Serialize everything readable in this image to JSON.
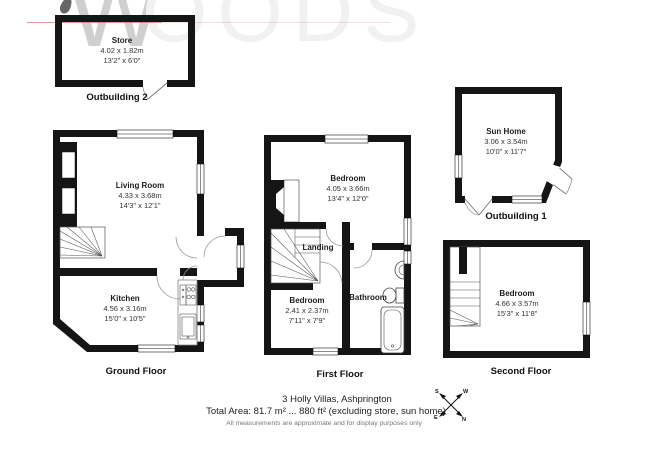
{
  "watermark": {
    "initial": "W",
    "rest": "OODS"
  },
  "outbuilding2": {
    "caption": "Outbuilding 2",
    "room": {
      "name": "Store",
      "metric": "4.02 x 1.82m",
      "imperial": "13'2\" x 6'0\""
    }
  },
  "ground_floor": {
    "caption": "Ground Floor",
    "living_room": {
      "name": "Living Room",
      "metric": "4.33 x 3.68m",
      "imperial": "14'3\" x 12'1\""
    },
    "kitchen": {
      "name": "Kitchen",
      "metric": "4.56 x 3.16m",
      "imperial": "15'0\" x 10'5\""
    }
  },
  "first_floor": {
    "caption": "First Floor",
    "bedroom1": {
      "name": "Bedroom",
      "metric": "4.05 x 3.66m",
      "imperial": "13'4\" x 12'0\""
    },
    "bedroom2": {
      "name": "Bedroom",
      "metric": "2.41 x 2.37m",
      "imperial": "7'11\" x 7'9\""
    },
    "bathroom": {
      "name": "Bathroom"
    },
    "landing": {
      "name": "Landing"
    }
  },
  "outbuilding1": {
    "caption": "Outbuilding 1",
    "room": {
      "name": "Sun Home",
      "metric": "3.06 x 3.54m",
      "imperial": "10'0\" x 11'7\""
    }
  },
  "second_floor": {
    "caption": "Second Floor",
    "room": {
      "name": "Bedroom",
      "metric": "4.66 x 3.57m",
      "imperial": "15'3\" x 11'8\""
    }
  },
  "footer": {
    "address": "3 Holly Villas, Ashprington",
    "total_area": "Total Area: 81.7 m² ... 880 ft² (excluding store, sun home)",
    "disclaimer": "All measurements are approximate and for display purposes only"
  },
  "compass": {
    "s": "S",
    "w": "W",
    "e": "E",
    "n": "N"
  },
  "colors": {
    "wall": "#151515",
    "watermark": "#cfcfcf",
    "red_line": "#d96a5f"
  }
}
